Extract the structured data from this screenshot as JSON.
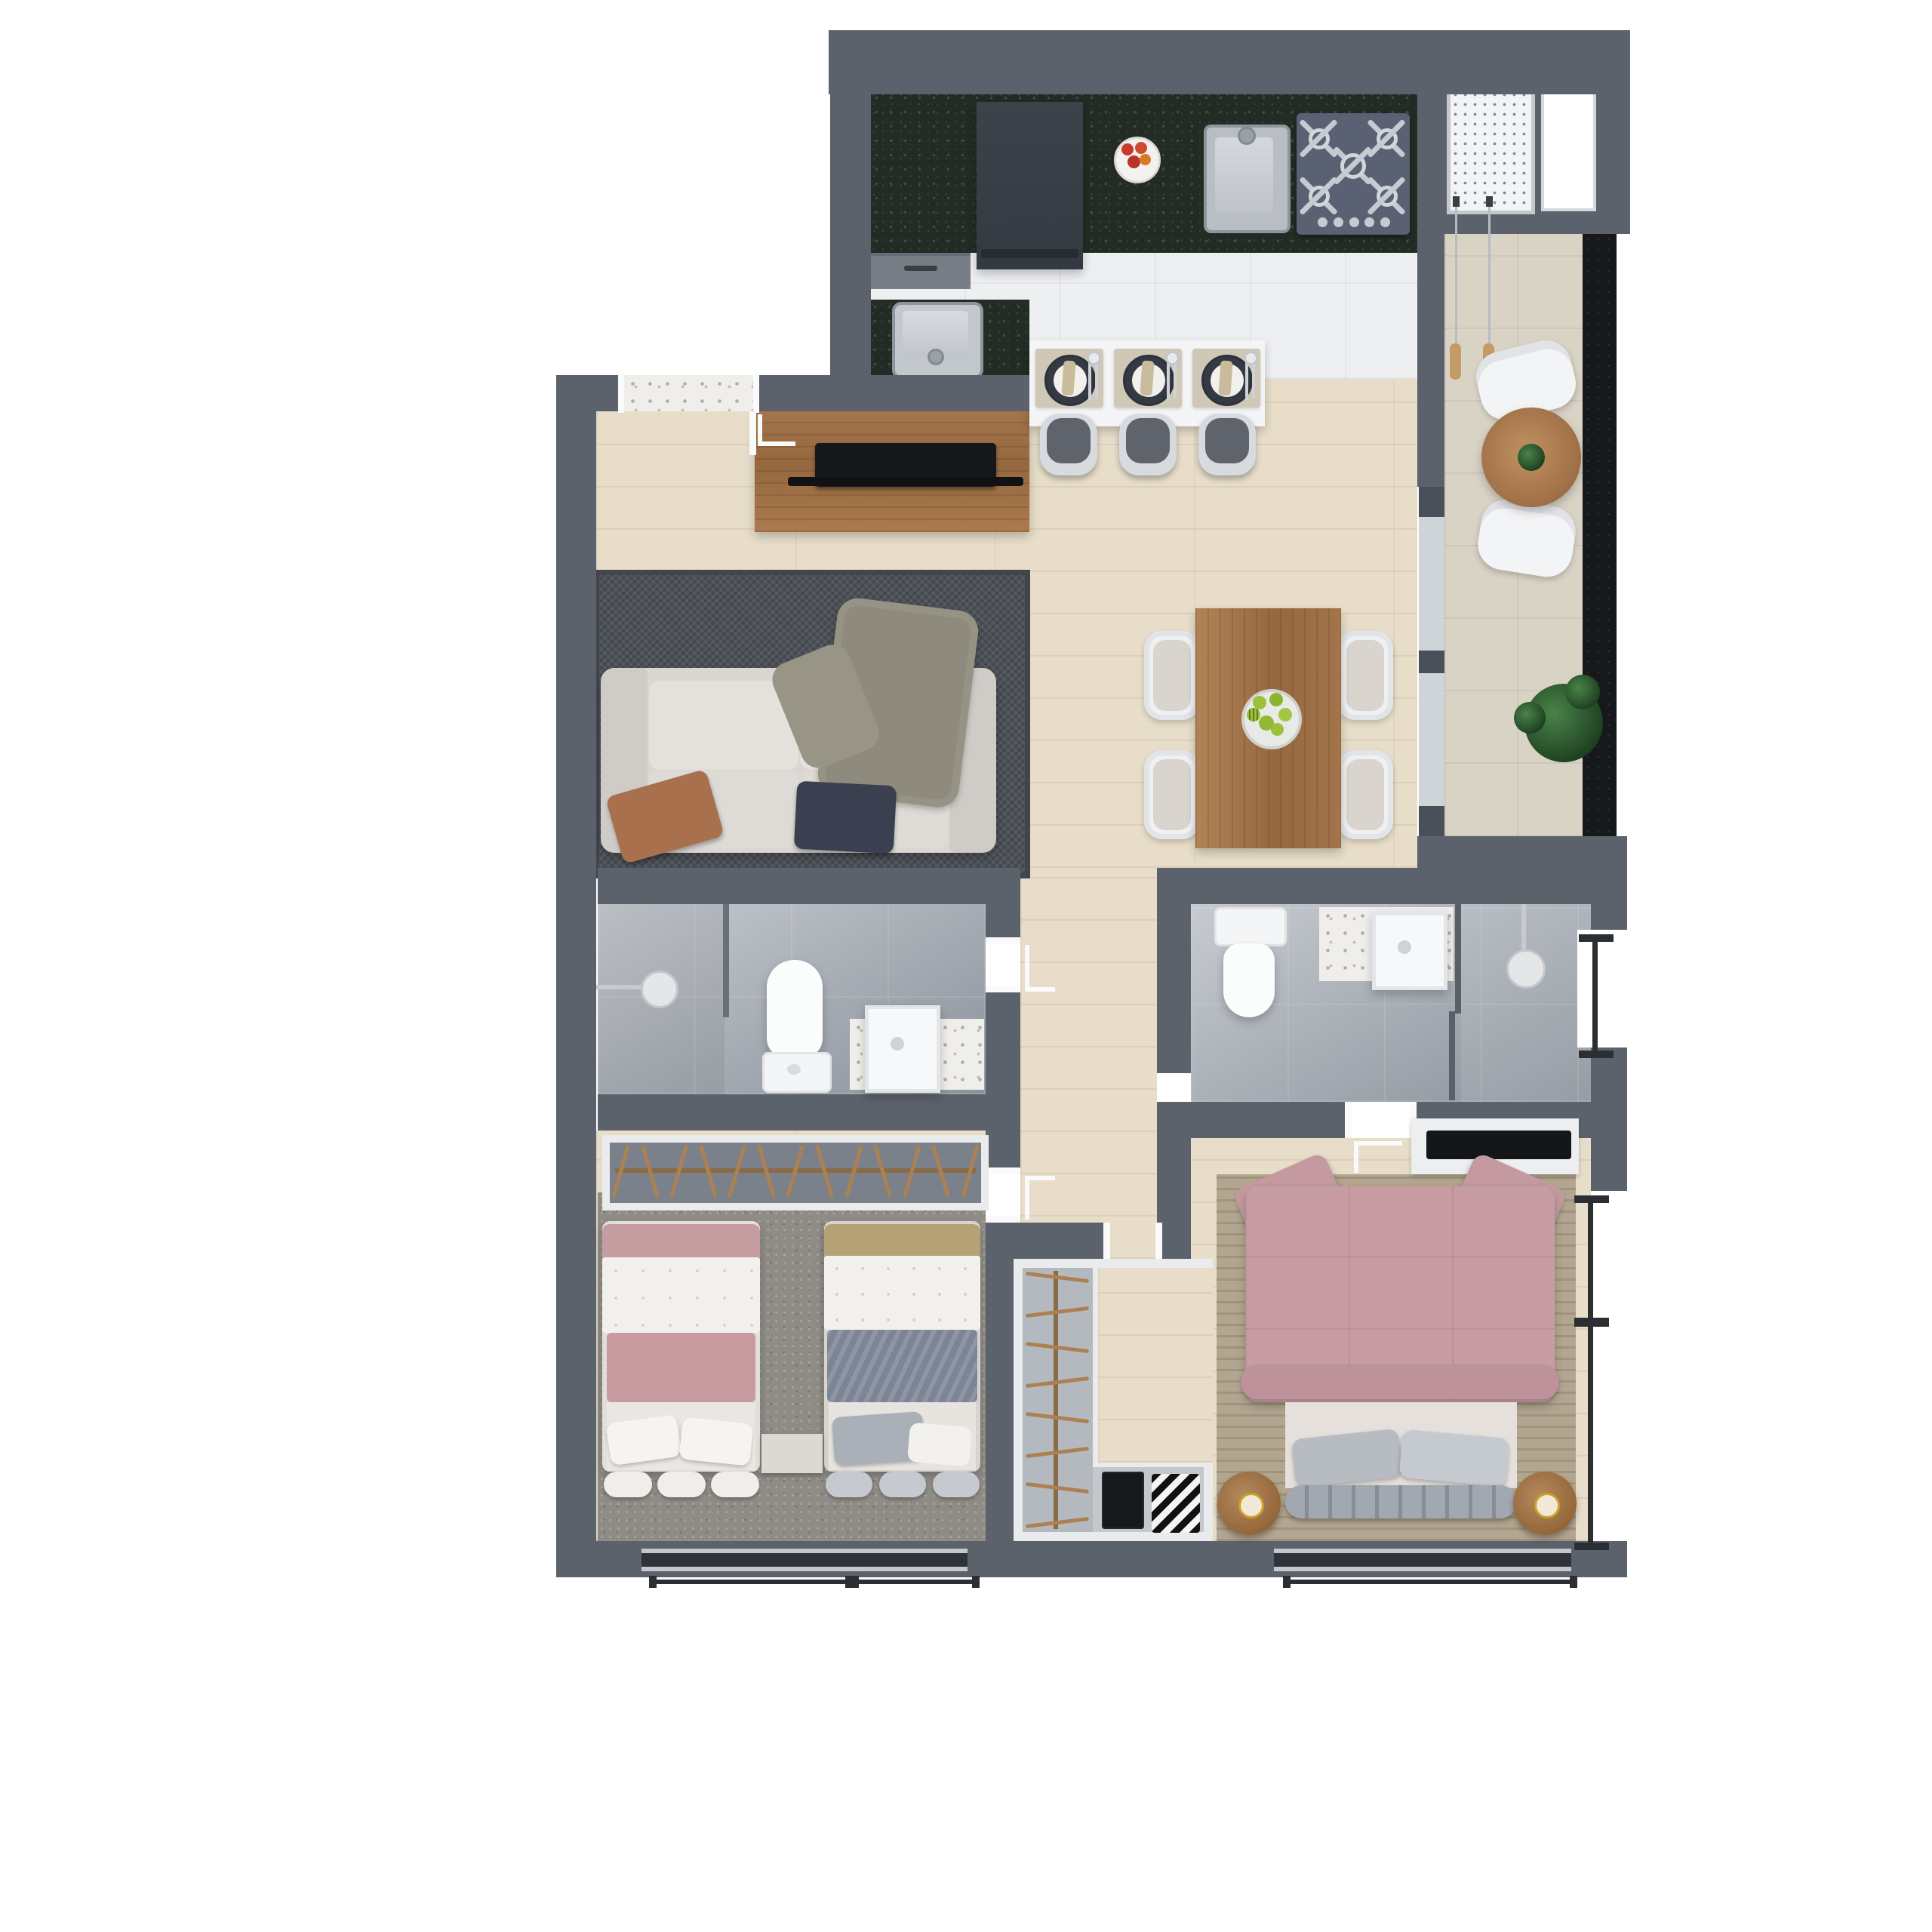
{
  "scene": {
    "description": "Top-down 3D rendered floor plan of a two-bedroom apartment on a white background",
    "view": "top-down render",
    "background": "#ffffff"
  },
  "palette": {
    "wall": "#5c626b",
    "granite_counter": "#232b25",
    "balcony_granite": "#16181b",
    "wood_floor": "#e7ddc9",
    "white_tile": "#edeff1",
    "beige_tile": "#d9d3c6",
    "bath_floor": "#9aa1a9",
    "wood_furniture": "#a4744a",
    "living_rug": "#4d5158",
    "accent_pink": "#c79da3",
    "accent_blue_gray": "#7c8596",
    "accent_brown": "#a8704d",
    "accent_navy": "#3a4050",
    "fixture_white": "#f7f8f9"
  },
  "rooms": {
    "kitchen": {
      "label": "Kitchen"
    },
    "service": {
      "label": "Laundry / service area"
    },
    "balcony": {
      "label": "Balcony"
    },
    "living": {
      "label": "Living room"
    },
    "dining": {
      "label": "Dining area"
    },
    "hallway": {
      "label": "Hallway"
    },
    "bath1": {
      "label": "Bathroom"
    },
    "bath2": {
      "label": "En-suite bathroom"
    },
    "kids": {
      "label": "Twin bedroom"
    },
    "master": {
      "label": "Master bedroom"
    },
    "closet": {
      "label": "Walk-in closet"
    }
  },
  "furniture": {
    "sofa": {
      "label": "Two-seat sofa with brown and navy pillows and a throw blanket"
    },
    "tv_console": {
      "label": "Wood TV console with flat TV"
    },
    "living_rug": {
      "label": "Dark gray area rug"
    },
    "dining_table": {
      "label": "Wood dining table with bowl of green apples"
    },
    "breakfast_bar": {
      "label": "White breakfast bar with three place settings"
    },
    "fridge": {
      "label": "Built-in appliance"
    },
    "fruit_bowl": {
      "label": "Bowl of red apples"
    },
    "kitchen_sink": {
      "label": "Stainless kitchen sink"
    },
    "prep_sink": {
      "label": "Stainless peninsula sink"
    },
    "cooktop": {
      "label": "Five-burner gas cooktop"
    },
    "laundry_tank": {
      "label": "Laundry wash tank"
    },
    "clothesline": {
      "label": "Hanging clothesline"
    },
    "balcony_table": {
      "label": "Round bistro table with plant"
    },
    "balcony_plant": {
      "label": "Potted plant"
    },
    "toilet1": {
      "label": "Toilet"
    },
    "toilet2": {
      "label": "Toilet"
    },
    "shower1": {
      "label": "Walk-in shower"
    },
    "shower2": {
      "label": "Walk-in shower"
    },
    "vanity1": {
      "label": "Vanity with vessel sink"
    },
    "vanity2": {
      "label": "Vanity with vessel sink"
    },
    "wardrobe_kids": {
      "label": "Open wardrobe with hangers"
    },
    "bed_single_1": {
      "label": "Single bed, pink bedding"
    },
    "bed_single_2": {
      "label": "Single bed, tan and blue bedding"
    },
    "kids_nightstand": {
      "label": "Nightstand"
    },
    "closet_unit": {
      "label": "L-shaped closet with hangers and folded clothes"
    },
    "bed_master": {
      "label": "Double bed with pink quilted duvet"
    },
    "nightstand_l": {
      "label": "Round wood nightstand with lamp"
    },
    "nightstand_r": {
      "label": "Round wood nightstand with lamp"
    },
    "tv_master": {
      "label": "Wall-mounted TV panel"
    }
  },
  "counts": {
    "place_settings": 3,
    "bar_stools": 3,
    "dining_chairs": 4,
    "balcony_chairs": 2,
    "cooktop_knobs": 5,
    "kids_hangers": 13,
    "closet_hangers": 8,
    "bed_bolsters": 3,
    "single_beds": 2
  }
}
